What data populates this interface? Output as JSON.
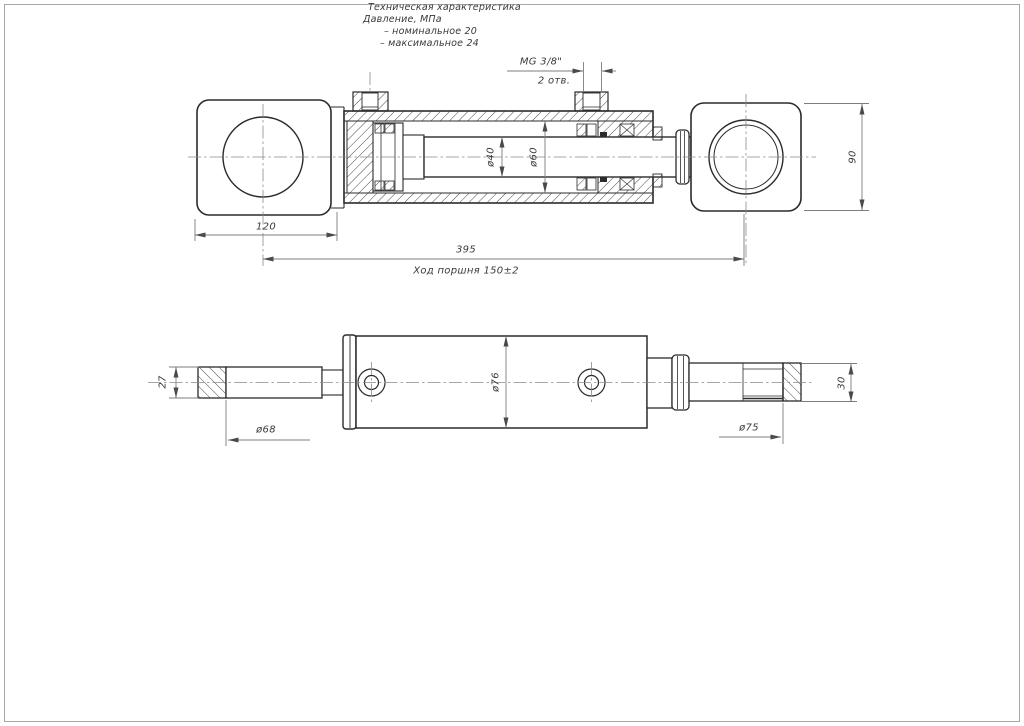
{
  "spec": {
    "title": "Техническая характеристика",
    "pressure_label": "Давление, МПа",
    "nominal": "– номинальное 20",
    "maximal": "– максимальное 24"
  },
  "ports": {
    "thread": "MG 3/8\"",
    "count": "2 отв."
  },
  "dims": {
    "eye_to_body": "120",
    "overall_length": "395",
    "piston_stroke": "Ход поршня 150±2",
    "eye_height": "90",
    "rod_diameter": "ø40",
    "bore_diameter": "ø60",
    "body_diameter": "ø76",
    "pin_flat": "27",
    "pin_diameter": "ø68",
    "rod_end_diameter": "ø75",
    "rod_end_height": "30"
  },
  "colors": {
    "line": "#2b2b2b",
    "thin_line": "#8a8a8a",
    "hatch": "#4a4a4a",
    "text": "#3a3a3a",
    "frame": "#a8a8a8",
    "background": "#ffffff"
  }
}
